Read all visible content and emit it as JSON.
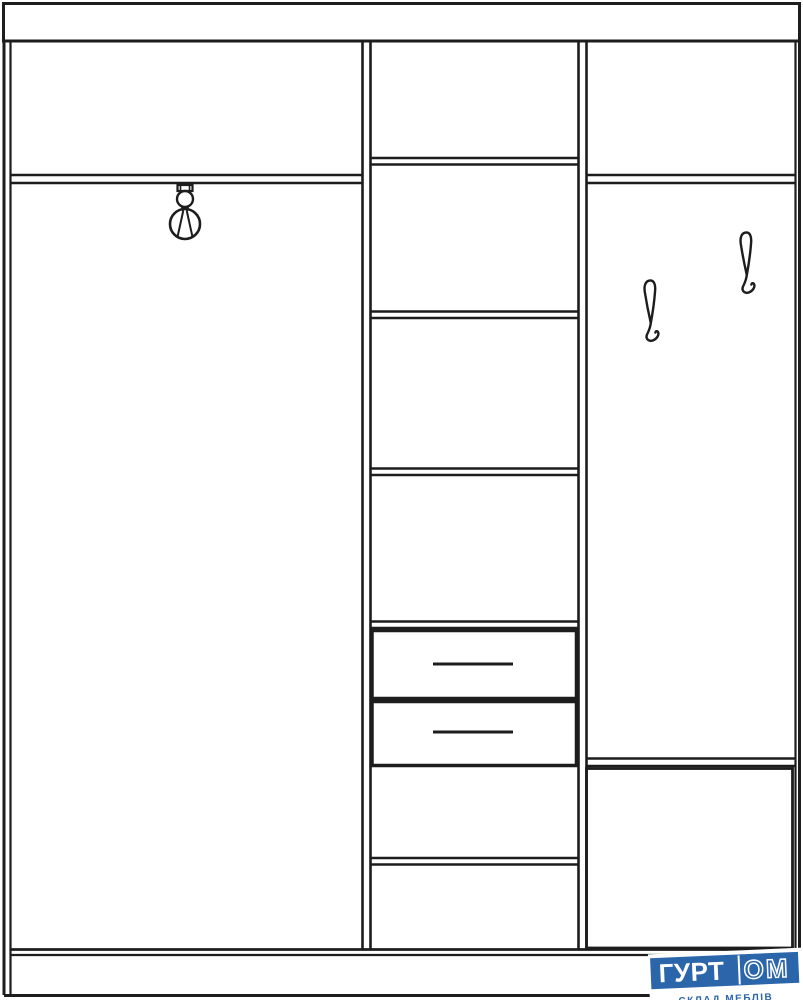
{
  "logo": {
    "brand_left": "ГУРТ",
    "brand_right": "ОМ",
    "tagline": "СКЛАД МЕБЛІВ"
  },
  "colors": {
    "line": "#1d1d1d",
    "background": "#ffffff",
    "logo_blue": "#2b66ab",
    "logo_text_white": "#ffffff"
  },
  "diagram": {
    "type": "furniture-schematic",
    "subject": "three-section hallway wardrobe, front elevation line drawing",
    "sections": [
      {
        "name": "left-section",
        "compartments": [
          "top shelf compartment",
          "tall hanging area with clothes-rail holder"
        ]
      },
      {
        "name": "middle-section",
        "compartments": [
          "top compartment",
          "three shelf compartments",
          "two drawers with handles",
          "two lower shelf compartments"
        ]
      },
      {
        "name": "right-section",
        "compartments": [
          "top shelf compartment",
          "open coat area with two hooks",
          "bottom cabinet box"
        ]
      }
    ],
    "counts": {
      "drawers": 2,
      "coat_hooks": 2,
      "middle_shelves": 5
    }
  }
}
